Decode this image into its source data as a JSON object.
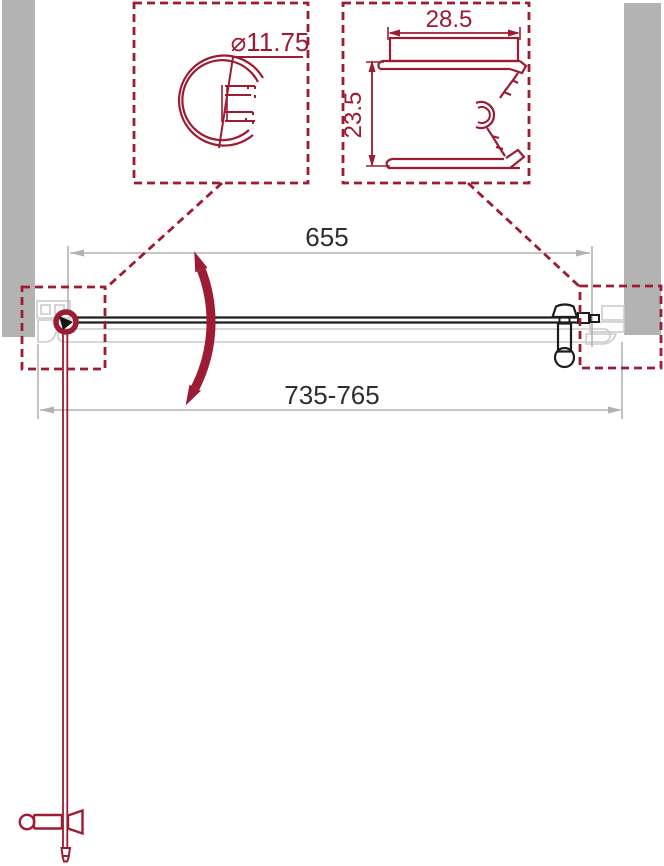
{
  "dimensions": {
    "glass_width": "655",
    "adjustment_range": "735-765",
    "knob_profile_diameter": "⌀11.75",
    "wall_profile_width": "28.5",
    "wall_profile_depth": "23.5"
  },
  "colors": {
    "accent_red": "#9d1b33",
    "wall_grey": "#b3b3b3",
    "dimension_line_grey": "#b2b2b2",
    "ghost_outline_grey": "#cbcbcb",
    "ink_black": "#1c1c1c",
    "dimension_text": "#2e2e2e",
    "background": "#ffffff"
  }
}
